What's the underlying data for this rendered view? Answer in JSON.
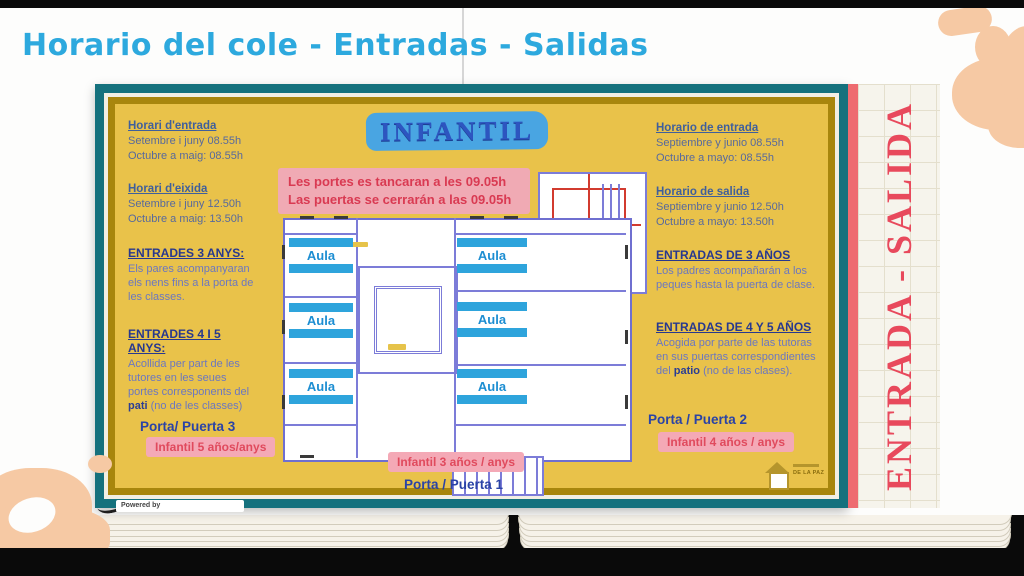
{
  "slide": {
    "title": "Horario del cole - Entradas - Salidas",
    "powered_by": "Powered by"
  },
  "poster": {
    "banner": "INFANTIL",
    "side_banner": "ENTRADA - SALIDA",
    "notice_line1": "Les portes es tancaran a les 09.05h",
    "notice_line2": "Las puertas se cerrarán a las 09.05h",
    "left": {
      "entry_heading": "Horari d'entrada",
      "entry_line1": "Setembre i juny 08.55h",
      "entry_line2": "Octubre a maig: 08.55h",
      "exit_heading": "Horari d'eixida",
      "exit_line1": "Setembre i juny 12.50h",
      "exit_line2": "Octubre a maig: 13.50h",
      "age3_heading": "ENTRADES 3 ANYS:",
      "age3_text": "Els pares acompanyaran els nens fins a la porta de les classes.",
      "age45_heading": "ENTRADES 4 I 5 ANYS:",
      "age45_text_pre": "Acollida per part de les tutores en les seues portes corresponents del ",
      "age45_text_bold": "pati",
      "age45_text_post": " (no de les classes)",
      "door_label": "Porta/ Puerta 3",
      "door_badge": "Infantil 5 años/anys"
    },
    "right": {
      "entry_heading": "Horario de entrada",
      "entry_line1": "Septiembre y junio 08.55h",
      "entry_line2": "Octubre a mayo: 08.55h",
      "exit_heading": "Horario de salida",
      "exit_line1": "Septiembre y junio 12.50h",
      "exit_line2": "Octubre a mayo: 13.50h",
      "age3_heading": "ENTRADAS DE 3 AÑOS",
      "age3_text": "Los padres acompañarán a los peques hasta la puerta de clase.",
      "age45_heading": "ENTRADAS DE 4 Y 5 AÑOS",
      "age45_text_pre": "Acogida por parte de las tutoras en sus puertas correspondientes del ",
      "age45_text_bold": "patio",
      "age45_text_post": " (no de las clases).",
      "door_label": "Porta / Puerta 2",
      "door_badge": "Infantil 4 años / anys"
    },
    "bottom": {
      "badge": "Infantil 3 años / anys",
      "door_label": "Porta / Puerta 1"
    },
    "plan": {
      "rooms": [
        "Aula",
        "Aula",
        "Aula",
        "Aula",
        "Aula",
        "Aula"
      ]
    },
    "logo_caption": "DE LA PAZ"
  },
  "colors": {
    "title_blue": "#2da9de",
    "poster_yellow": "#e9c24a",
    "frame_teal": "#15717d",
    "frame_gold": "#a8860d",
    "banner_blue": "#49a5e2",
    "notice_pink": "#f0aab4",
    "accent_red": "#e8495c",
    "heading_blue": "#3f5f9c",
    "navy": "#27388f",
    "aula_blue": "#1d8ed2",
    "blob_peach": "#f6c9a4"
  }
}
